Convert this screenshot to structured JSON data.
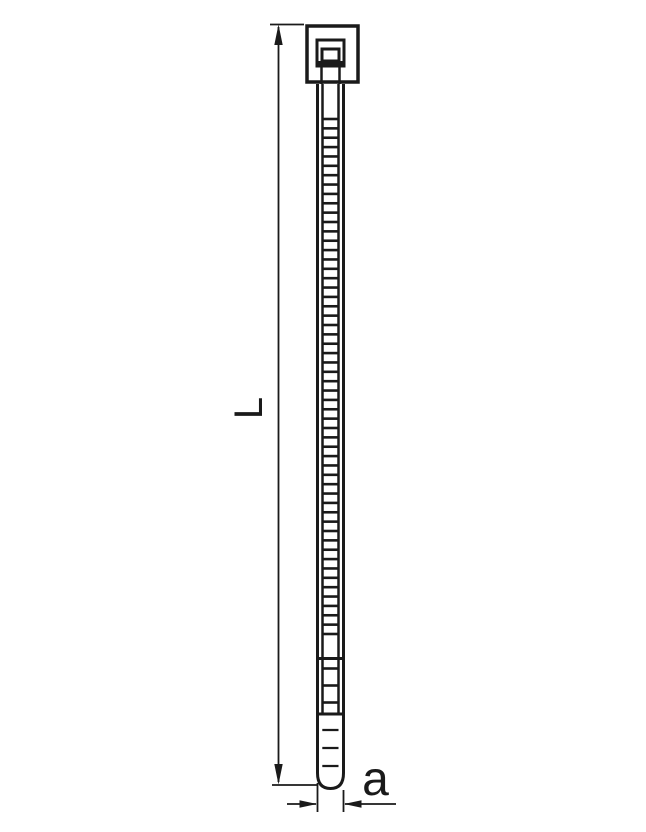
{
  "diagram": {
    "labels": {
      "length": "L",
      "width": "a"
    }
  },
  "colors": {
    "line": "#1a1a1a",
    "background": "#ffffff"
  },
  "geometry": {
    "dense_ribs": {
      "start_y": 119,
      "end_y": 634,
      "count": 56,
      "x1": 322.5,
      "x2": 338.5
    },
    "transition_ribs": {
      "ys": [
        668.5,
        685.5,
        702.5
      ],
      "x1": 322.5,
      "x2": 338.5
    },
    "tip_ticks": {
      "ys": [
        730,
        748,
        766
      ],
      "x1": 322.3,
      "x2": 338.5
    }
  }
}
